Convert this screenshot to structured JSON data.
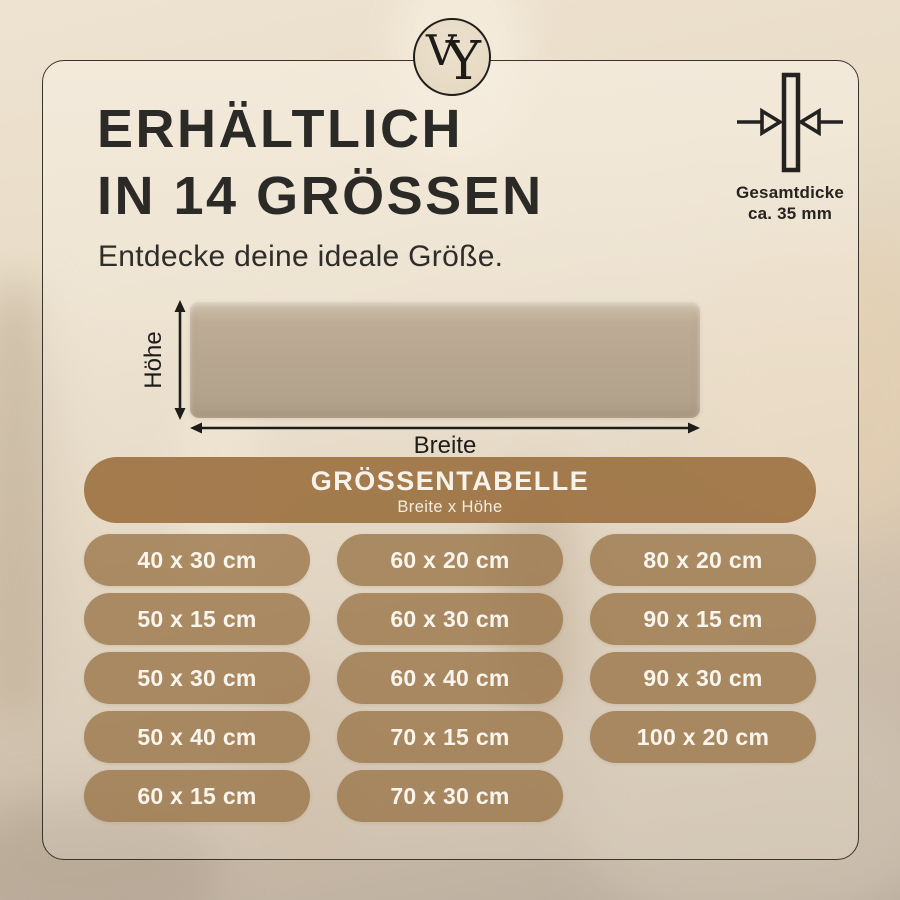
{
  "brand": {
    "monogram_v": "V",
    "monogram_y": "Y"
  },
  "header": {
    "title_line1": "ERHÄLTLICH",
    "title_line2": "IN 14 GRÖSSEN",
    "subtitle": "Entdecke deine ideale Größe."
  },
  "thickness": {
    "line1": "Gesamtdicke",
    "line2": "ca. 35 mm"
  },
  "diagram": {
    "height_label": "Höhe",
    "width_label": "Breite"
  },
  "size_table": {
    "title": "GRÖSSENTABELLE",
    "subtitle": "Breite x Höhe",
    "columns": [
      [
        "40 x 30 cm",
        "50 x 15 cm",
        "50 x 30 cm",
        "50 x 40 cm",
        "60 x 15 cm"
      ],
      [
        "60 x 20 cm",
        "60 x 30 cm",
        "60 x 40 cm",
        "70 x 15 cm",
        "70 x 30 cm"
      ],
      [
        "80 x 20 cm",
        "90 x 15 cm",
        "90 x 30 cm",
        "100 x 20 cm"
      ]
    ]
  },
  "colors": {
    "accent_brown": "#a9825c",
    "pill_brown": "#a88962",
    "text_dark": "#2c2a27",
    "pill_text": "#faf5ec",
    "panel_taupe": "#b7a68f",
    "card_border": "#3b342b"
  }
}
